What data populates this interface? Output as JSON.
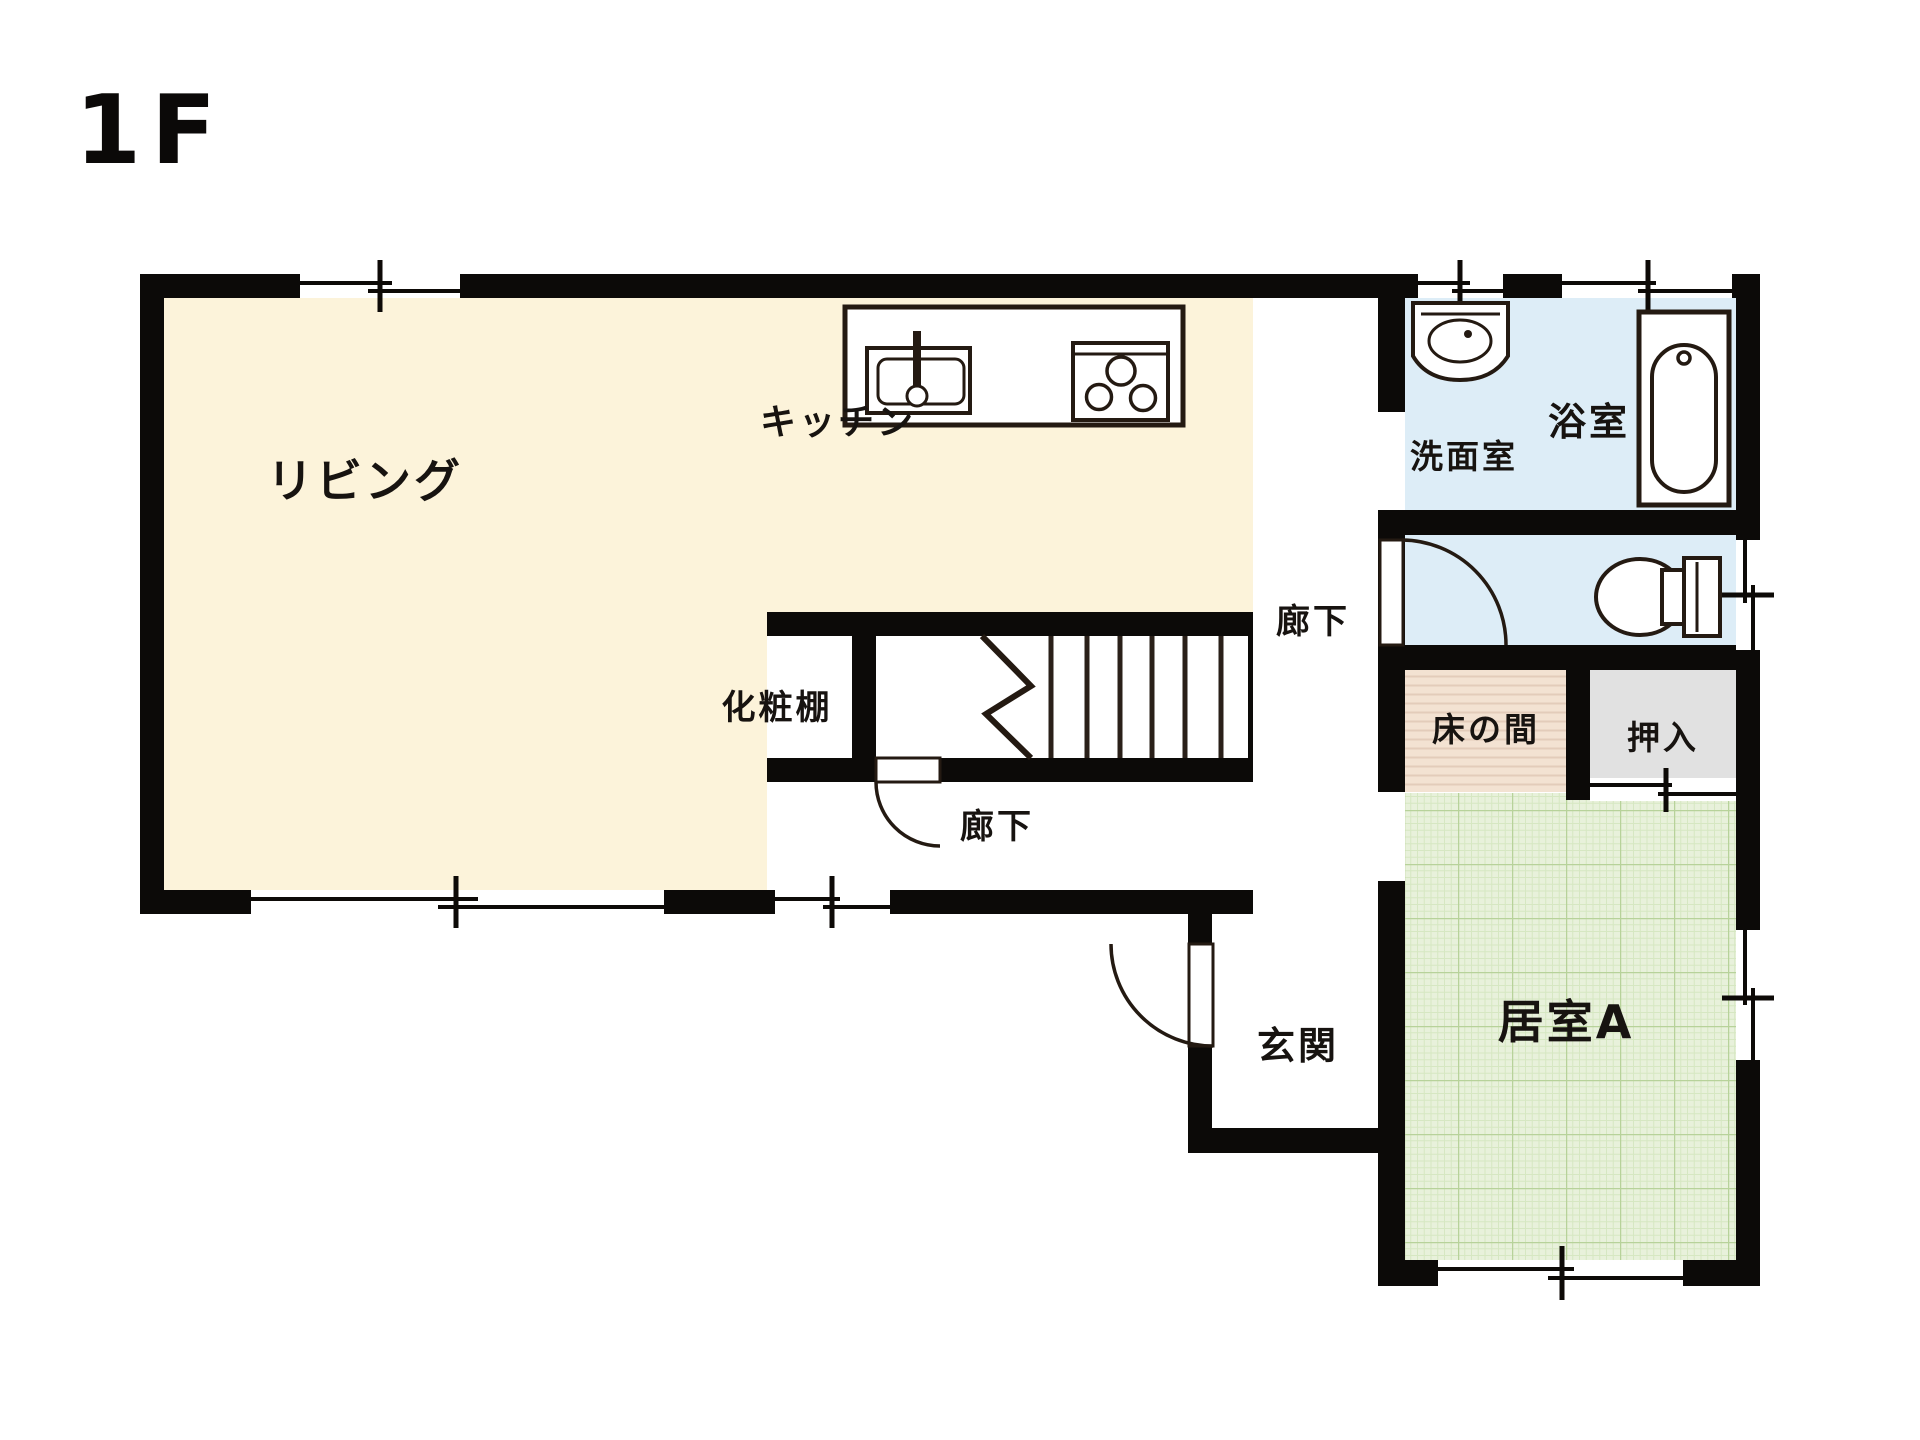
{
  "title": {
    "floor_label": "1F"
  },
  "rooms": {
    "living": {
      "label": "リビング"
    },
    "kitchen": {
      "label": "キッチン"
    },
    "vanity_shelf": {
      "label": "化粧棚"
    },
    "corridor_lower": {
      "label": "廊下"
    },
    "corridor_upper": {
      "label": "廊下"
    },
    "washroom": {
      "label": "洗面室"
    },
    "bathroom": {
      "label": "浴室"
    },
    "tokonoma": {
      "label": "床の間"
    },
    "closet": {
      "label": "押入"
    },
    "room_a": {
      "label": "居室A"
    },
    "entrance": {
      "label": "玄関"
    }
  },
  "fixtures": {
    "sink": "kitchen-sink",
    "stove": "three-burner-stove",
    "washbasin": "washbasin",
    "bathtub": "bathtub",
    "toilet": "toilet",
    "stairs": "staircase-with-break-mark",
    "doors": "swing-door-arcs",
    "windows": "sliding-window-symbols",
    "sliding_door": "closet-sliding-door"
  },
  "colors": {
    "wall": "#0c0a08",
    "living": "#fcf3da",
    "kitchen": "#fcf3da",
    "wet_area": "#ddedf7",
    "tokonoma_base": "#f3e2d2",
    "closet": "#e1e1e1",
    "tatami_base": "#e8f1db",
    "line": "#241a12",
    "background": "#ffffff"
  }
}
